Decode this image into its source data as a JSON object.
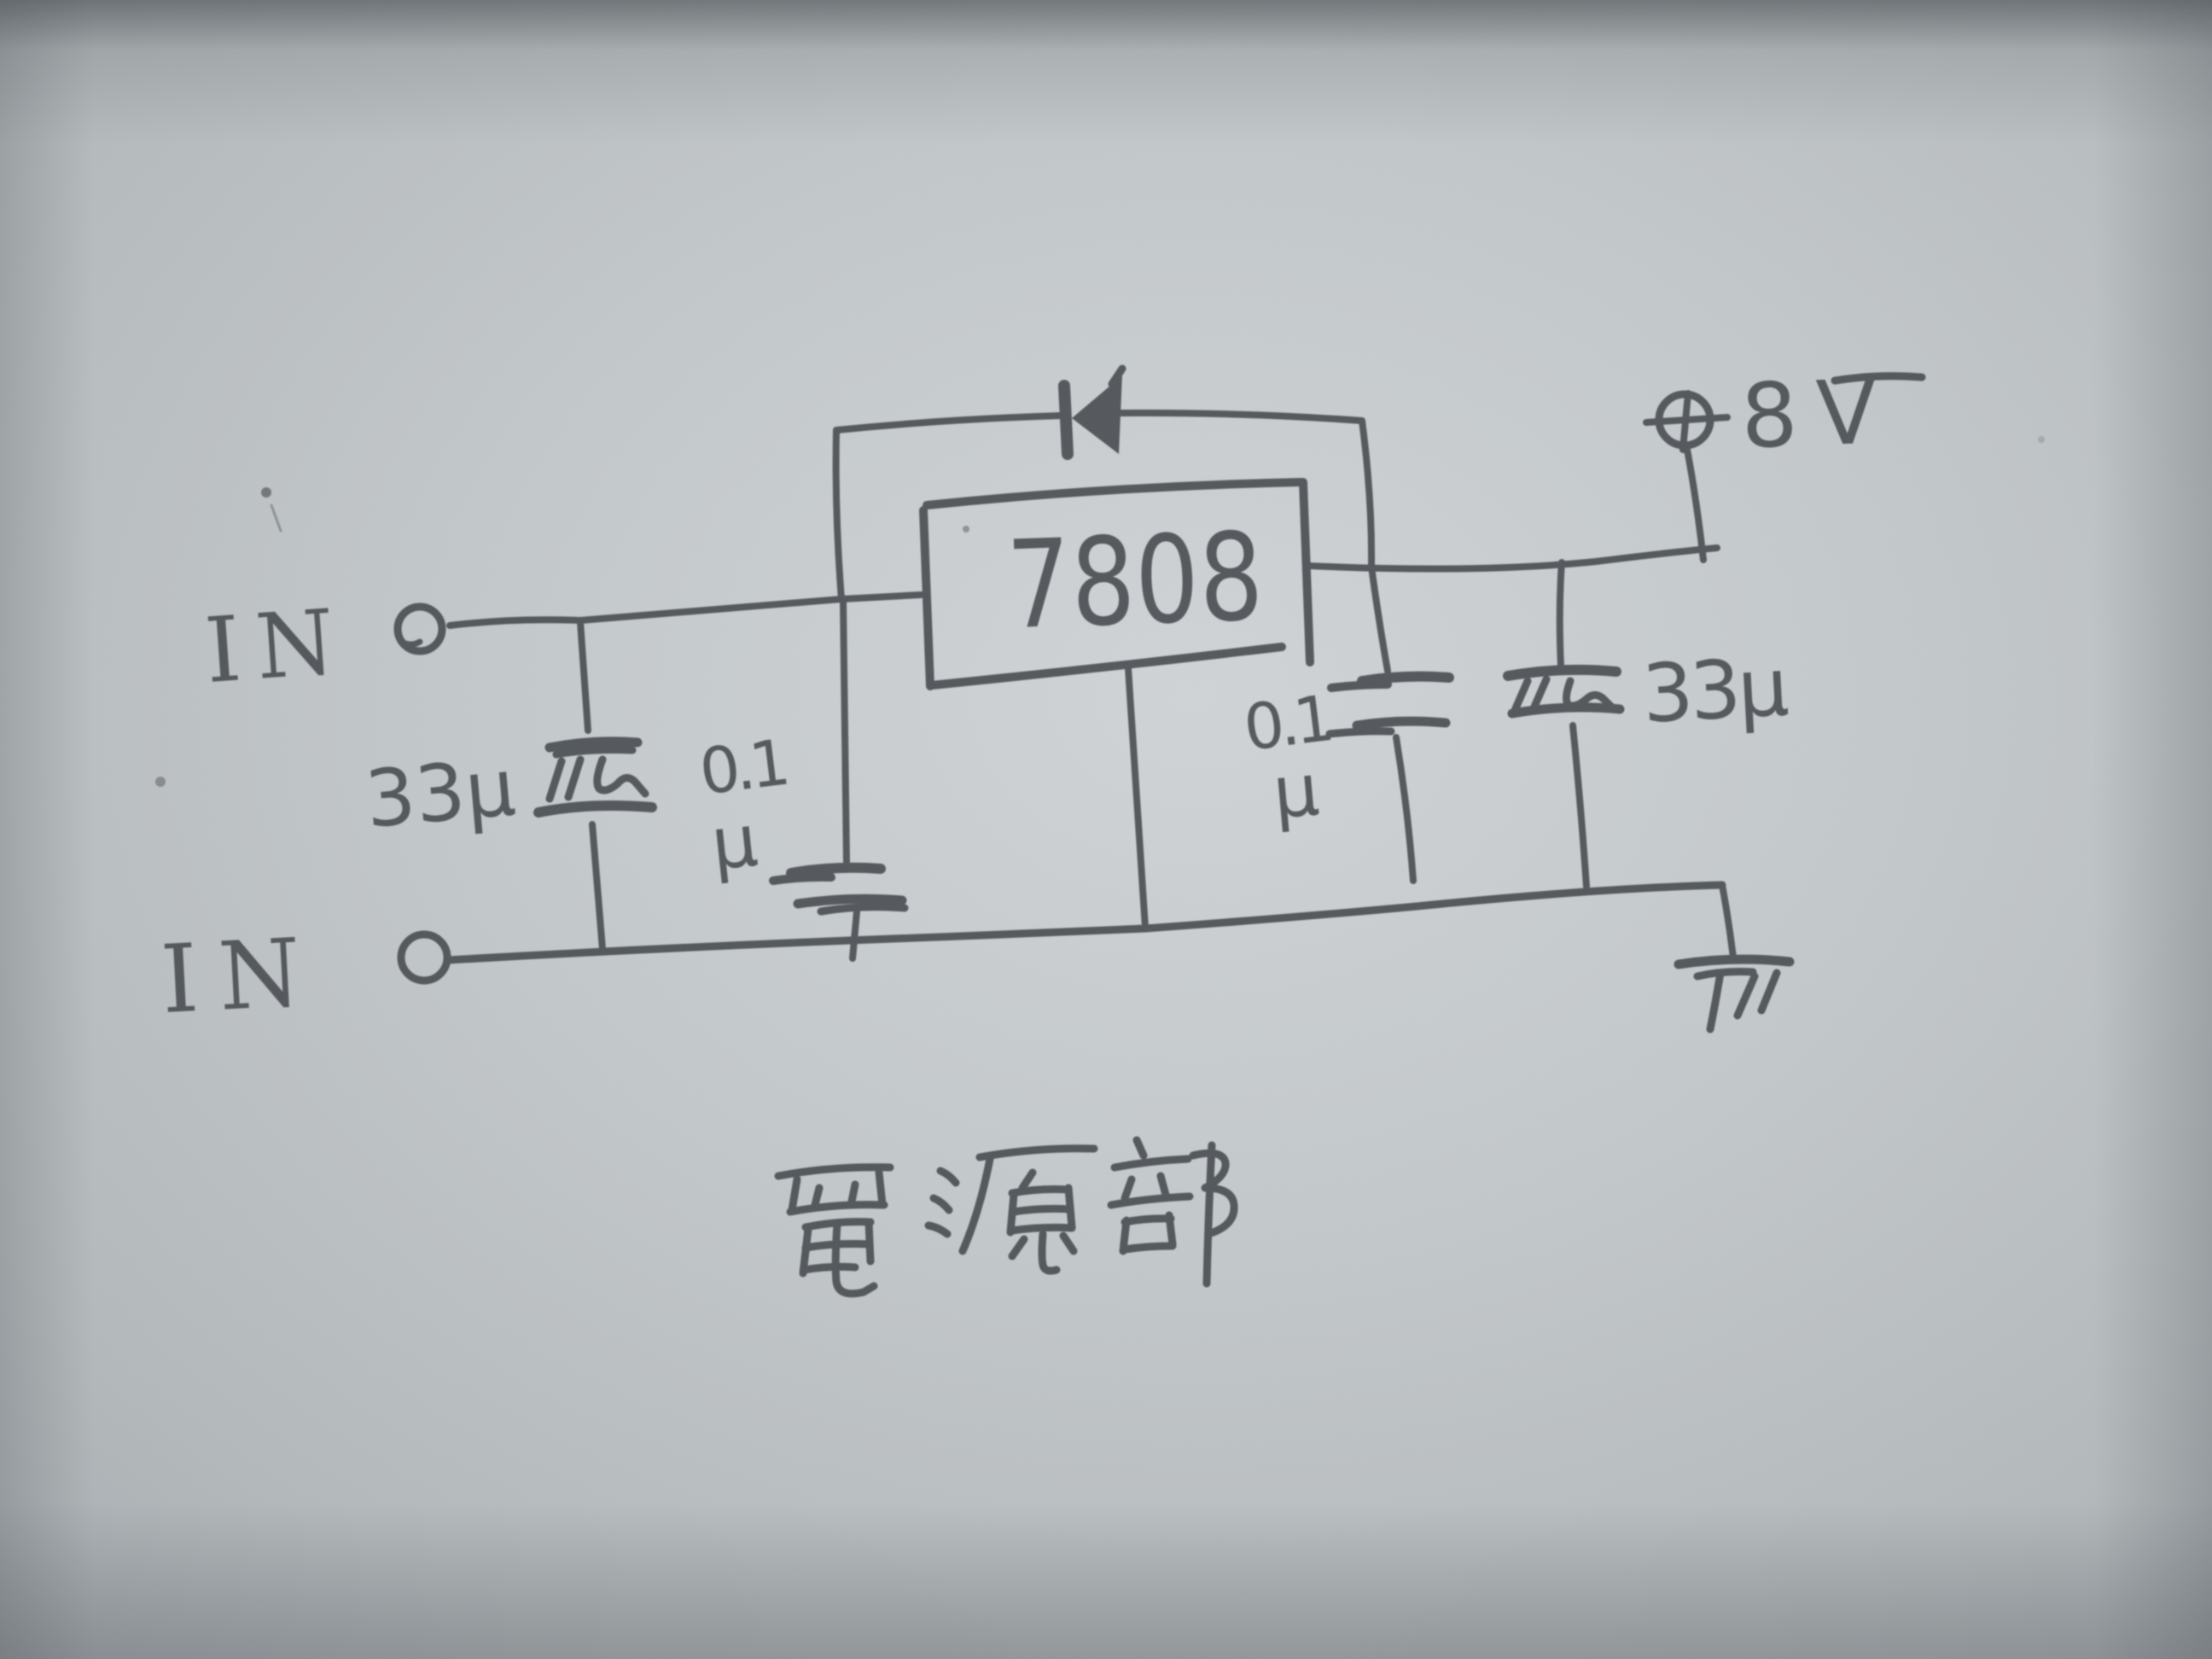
{
  "title": "電源部",
  "terminals": {
    "input_top": {
      "label": "IN"
    },
    "input_bottom": {
      "label": "IN"
    },
    "output": {
      "symbol": "⊕",
      "voltage": "8V"
    }
  },
  "regulator": {
    "label": "7808"
  },
  "capacitors": [
    {
      "position": "input-bulk-electrolytic",
      "value": "33µ"
    },
    {
      "position": "input-bypass",
      "value": "0.1",
      "unit": "µ"
    },
    {
      "position": "output-bypass",
      "value": "0.1",
      "unit": "µ"
    },
    {
      "position": "output-bulk-electrolytic",
      "value": "33µ"
    }
  ],
  "diode": {
    "description": "protection diode across regulator, pointing toward input"
  },
  "ground": {
    "description": "hatched ground symbol at right end of bottom rail"
  },
  "colors": {
    "paper": "#c3c8ca",
    "paper-light": "#cfd3d4",
    "paper-dark": "#a6abae",
    "pencil": "#4b4f53"
  }
}
